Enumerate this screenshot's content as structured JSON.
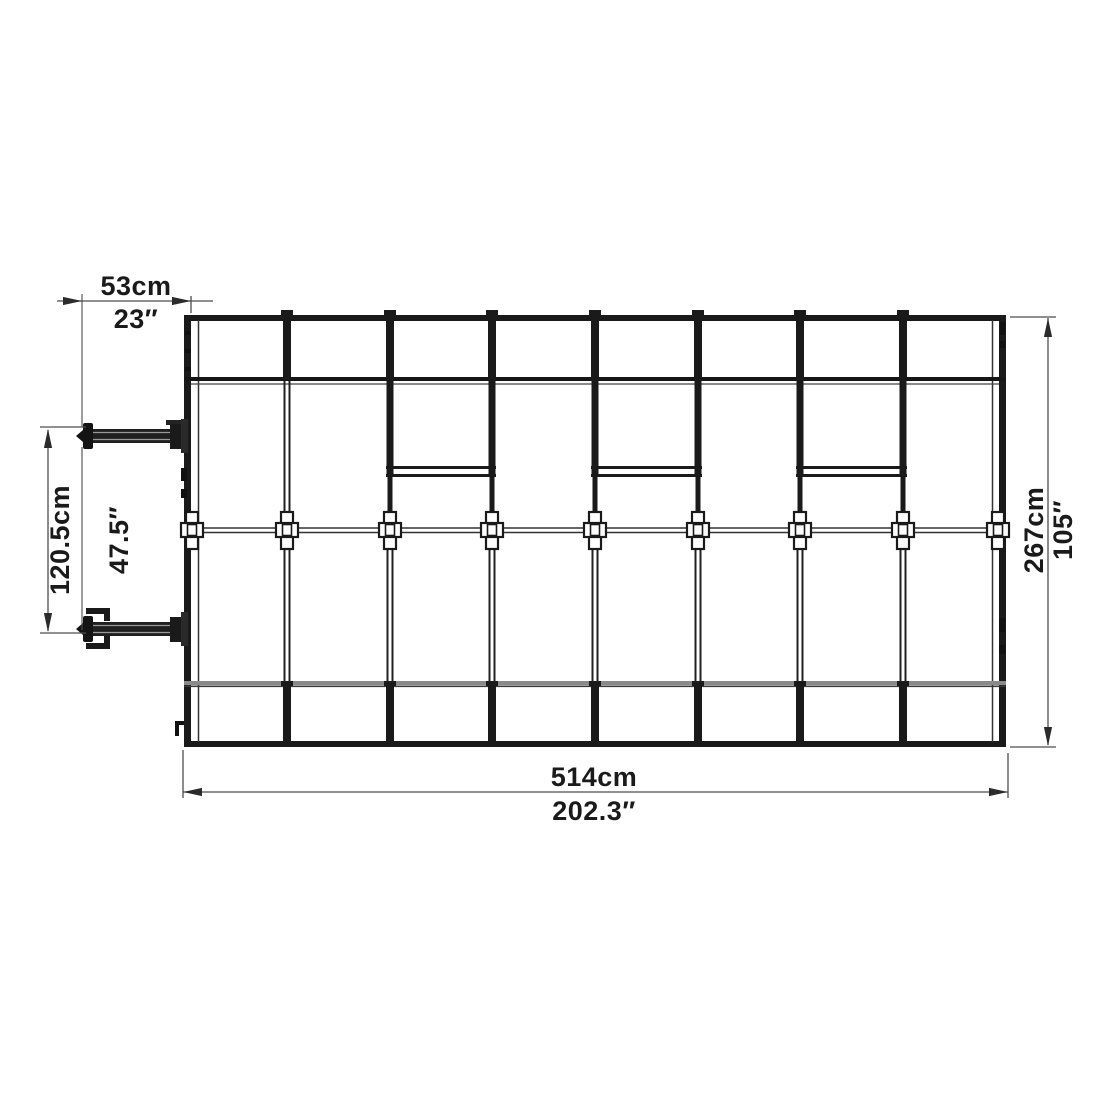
{
  "drawing": {
    "kind": "greenhouse-top-view-dimension-drawing",
    "colors": {
      "line": "#1a1a1a",
      "mid_line": "#222222",
      "dim": "#4d4d4d",
      "band_gray": "#8a8a8a",
      "band_gray_edge": "#3a3a3a",
      "hinge_dark": "#1f1f1f",
      "background": "#ffffff"
    },
    "dimensions": {
      "top": {
        "cm": "53cm",
        "inch": "23″"
      },
      "left": {
        "cm": "120.5cm",
        "inch": "47.5″"
      },
      "right": {
        "cm": "267cm",
        "inch": "105″"
      },
      "bottom": {
        "cm": "514cm",
        "inch": "202.3″"
      }
    }
  }
}
